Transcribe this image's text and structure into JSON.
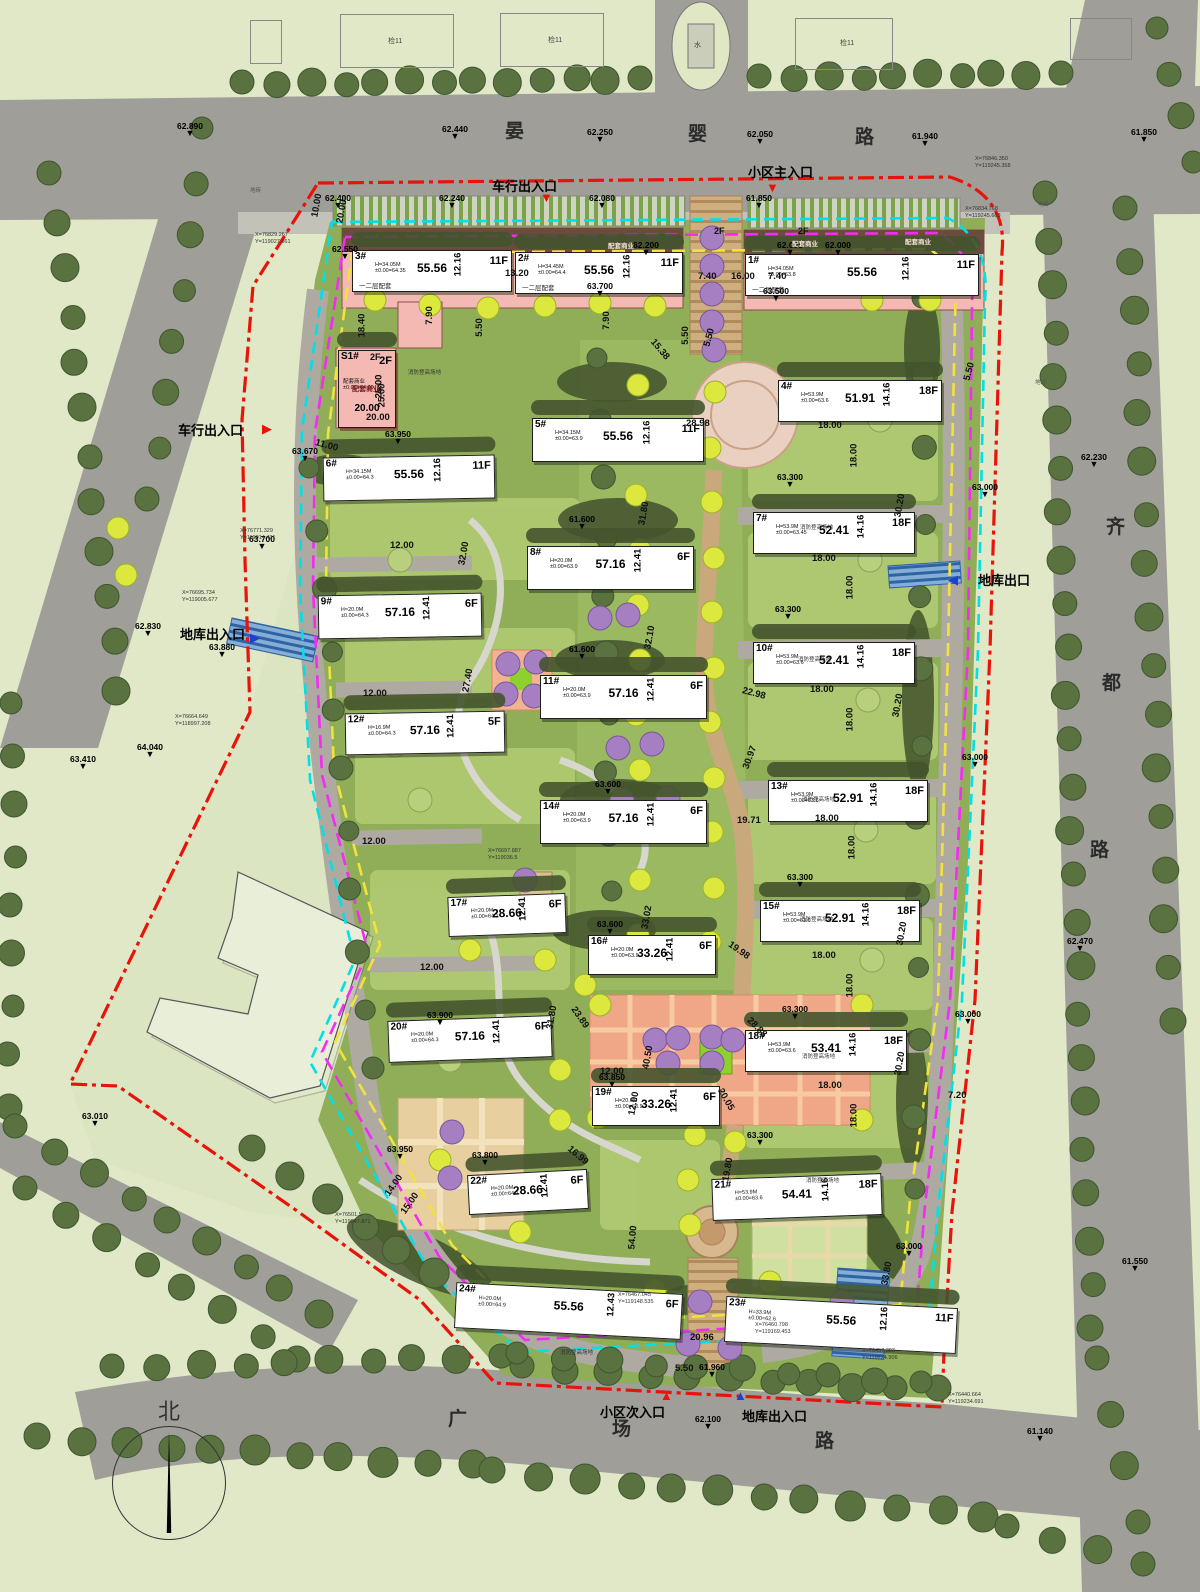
{
  "title": "住宅小区总平面图",
  "colors": {
    "boundary_red": "#e81309",
    "boundary_cyan": "#00e0e6",
    "boundary_magenta": "#f32bf3",
    "setback_yellow": "#f2e23c",
    "road_gray": "#9f9e99",
    "site_green": "#8fae57",
    "podium_pink": "#f3b9b2",
    "axis_tan": "#c9a87c",
    "plaza_orange": "#efa788",
    "tree_olive": "#5a7140",
    "tree_yellow": "#dce83e",
    "tree_purple": "#a57fc2",
    "ramp_blue": "#2f63a4",
    "entry_red": "#e81309",
    "entry_blue": "#1d3fd4"
  },
  "compass": {
    "label": "北"
  },
  "roads": {
    "north": {
      "name": "晏婴路",
      "chars": [
        {
          "ch": "晏",
          "x": 505,
          "y": 116
        },
        {
          "ch": "婴",
          "x": 688,
          "y": 119
        },
        {
          "ch": "路",
          "x": 855,
          "y": 122
        }
      ]
    },
    "east": {
      "name": "齐都路",
      "chars": [
        {
          "ch": "齐",
          "x": 1106,
          "y": 512
        },
        {
          "ch": "都",
          "x": 1102,
          "y": 668
        },
        {
          "ch": "路",
          "x": 1090,
          "y": 835
        }
      ]
    },
    "south": {
      "name": "广场路",
      "chars": [
        {
          "ch": "广",
          "x": 448,
          "y": 1404
        },
        {
          "ch": "场",
          "x": 612,
          "y": 1414
        },
        {
          "ch": "路",
          "x": 815,
          "y": 1426
        }
      ]
    }
  },
  "entrances": [
    {
      "label": "车行出入口",
      "x": 492,
      "y": 176,
      "ax": 540,
      "ay": 190,
      "glyph": "▼",
      "color": "#e81309"
    },
    {
      "label": "小区主入口",
      "x": 748,
      "y": 162,
      "ax": 766,
      "ay": 180,
      "glyph": "▼",
      "color": "#e81309"
    },
    {
      "label": "车行出入口",
      "x": 178,
      "y": 420,
      "ax": 262,
      "ay": 421,
      "glyph": "▶",
      "color": "#e81309"
    },
    {
      "label": "地库出入口",
      "x": 180,
      "y": 624,
      "ax": 250,
      "ay": 630,
      "glyph": "▶",
      "color": "#1d3fd4"
    },
    {
      "label": "地库出口",
      "x": 978,
      "y": 570,
      "ax": 948,
      "ay": 572,
      "glyph": "◀",
      "color": "#1d3fd4"
    },
    {
      "label": "小区次入口",
      "x": 600,
      "y": 1402,
      "ax": 660,
      "ay": 1388,
      "glyph": "▲",
      "color": "#e81309"
    },
    {
      "label": "地库出入口",
      "x": 742,
      "y": 1406,
      "ax": 734,
      "ay": 1388,
      "glyph": "▲",
      "color": "#1d3fd4"
    }
  ],
  "buildings": [
    {
      "id": "3#",
      "x": 352,
      "y": 250,
      "w": 158,
      "h": 40,
      "r": 0,
      "len": "55.56",
      "dep": "12.16",
      "fl": "11F",
      "info": "H=34.05M\n±0.00=64.35",
      "note": "一二层配套"
    },
    {
      "id": "2#",
      "x": 515,
      "y": 252,
      "w": 166,
      "h": 40,
      "r": 0,
      "len": "55.56",
      "dep": "12.16",
      "fl": "11F",
      "info": "H=34.45M\n±0.00=64.4",
      "note": "一二层配套"
    },
    {
      "id": "1#",
      "x": 745,
      "y": 254,
      "w": 232,
      "h": 40,
      "r": 0,
      "len": "55.56",
      "dep": "12.16",
      "fl": "11F",
      "info": "H=34.05M\n±0.00=63.8",
      "note": "一二层配套"
    },
    {
      "id": "S1#",
      "x": 338,
      "y": 350,
      "w": 56,
      "h": 76,
      "r": 0,
      "len": "20.00",
      "dep": "25.00",
      "fl": "2F",
      "info": "配套商业\n±0.00=64.00",
      "pink": true
    },
    {
      "id": "6#",
      "x": 323,
      "y": 456,
      "w": 170,
      "h": 42,
      "r": -1,
      "len": "55.56",
      "dep": "12.16",
      "fl": "11F",
      "info": "H=34.15M\n±0.00=64.3"
    },
    {
      "id": "5#",
      "x": 532,
      "y": 418,
      "w": 170,
      "h": 42,
      "r": 0,
      "len": "55.56",
      "dep": "12.16",
      "fl": "11F",
      "info": "H=34.15M\n±0.00=63.9"
    },
    {
      "id": "4#",
      "x": 778,
      "y": 380,
      "w": 162,
      "h": 40,
      "r": 0,
      "len": "51.91",
      "dep": "14.16",
      "fl": "18F",
      "info": "H=53.9M\n±0.00=63.6"
    },
    {
      "id": "9#",
      "x": 318,
      "y": 594,
      "w": 162,
      "h": 42,
      "r": -1,
      "len": "57.16",
      "dep": "12.41",
      "fl": "6F",
      "info": "H=20.0M\n±0.00=64.3"
    },
    {
      "id": "8#",
      "x": 527,
      "y": 546,
      "w": 165,
      "h": 42,
      "r": 0,
      "len": "57.16",
      "dep": "12.41",
      "fl": "6F",
      "info": "H=20.0M\n±0.00=63.9"
    },
    {
      "id": "7#",
      "x": 753,
      "y": 512,
      "w": 160,
      "h": 40,
      "r": 0,
      "len": "52.41",
      "dep": "14.16",
      "fl": "18F",
      "info": "H=53.9M\n±0.00=63.45"
    },
    {
      "id": "12#",
      "x": 345,
      "y": 712,
      "w": 158,
      "h": 40,
      "r": -1,
      "len": "57.16",
      "dep": "12.41",
      "fl": "5F",
      "info": "H=16.9M\n±0.00=64.3"
    },
    {
      "id": "11#",
      "x": 540,
      "y": 675,
      "w": 165,
      "h": 42,
      "r": 0,
      "len": "57.16",
      "dep": "12.41",
      "fl": "6F",
      "info": "H=20.0M\n±0.00=63.9"
    },
    {
      "id": "10#",
      "x": 753,
      "y": 642,
      "w": 160,
      "h": 40,
      "r": 0,
      "len": "52.41",
      "dep": "14.16",
      "fl": "18F",
      "info": "H=53.9M\n±0.00=63.6"
    },
    {
      "id": "14#",
      "x": 540,
      "y": 800,
      "w": 165,
      "h": 42,
      "r": 0,
      "len": "57.16",
      "dep": "12.41",
      "fl": "6F",
      "info": "H=20.0M\n±0.00=63.9"
    },
    {
      "id": "13#",
      "x": 768,
      "y": 780,
      "w": 158,
      "h": 40,
      "r": 0,
      "len": "52.91",
      "dep": "14.16",
      "fl": "18F",
      "info": "H=53.9M\n±0.00=63.6"
    },
    {
      "id": "17#",
      "x": 448,
      "y": 895,
      "w": 116,
      "h": 38,
      "r": -2,
      "len": "28.66",
      "dep": "12.41",
      "fl": "6F",
      "info": "H=20.0M\n±0.00=64.1"
    },
    {
      "id": "16#",
      "x": 588,
      "y": 935,
      "w": 126,
      "h": 38,
      "r": 0,
      "len": "33.26",
      "dep": "12.41",
      "fl": "6F",
      "info": "H=20.0M\n±0.00=63.9"
    },
    {
      "id": "15#",
      "x": 760,
      "y": 900,
      "w": 158,
      "h": 40,
      "r": 0,
      "len": "52.91",
      "dep": "14.16",
      "fl": "18F",
      "info": "H=53.9M\n±0.00=63.6"
    },
    {
      "id": "20#",
      "x": 388,
      "y": 1018,
      "w": 162,
      "h": 40,
      "r": -2,
      "len": "57.16",
      "dep": "12.41",
      "fl": "6F",
      "info": "H=20.0M\n±0.00=64.3"
    },
    {
      "id": "19#",
      "x": 592,
      "y": 1086,
      "w": 126,
      "h": 38,
      "r": 0,
      "len": "33.26",
      "dep": "12.41",
      "fl": "6F",
      "info": "H=20.0M\n±0.00=63.9"
    },
    {
      "id": "18#",
      "x": 745,
      "y": 1030,
      "w": 160,
      "h": 40,
      "r": 0,
      "len": "53.41",
      "dep": "14.16",
      "fl": "18F",
      "info": "H=53.9M\n±0.00=63.6"
    },
    {
      "id": "22#",
      "x": 468,
      "y": 1172,
      "w": 118,
      "h": 38,
      "r": -3,
      "len": "28.66",
      "dep": "12.41",
      "fl": "6F",
      "info": "H=20.0M\n±0.00=64.1"
    },
    {
      "id": "21#",
      "x": 712,
      "y": 1176,
      "w": 168,
      "h": 40,
      "r": -2,
      "len": "54.41",
      "dep": "14.16",
      "fl": "18F",
      "info": "H=53.9M\n±0.00=63.6"
    },
    {
      "id": "24#",
      "x": 455,
      "y": 1288,
      "w": 225,
      "h": 44,
      "r": 3,
      "len": "55.56",
      "dep": "12.43",
      "fl": "6F",
      "info": "H=20.0M\n±0.00=64.9"
    },
    {
      "id": "23#",
      "x": 725,
      "y": 1302,
      "w": 230,
      "h": 44,
      "r": 3,
      "len": "55.56",
      "dep": "12.16",
      "fl": "11F",
      "info": "H=33.9M\n±0.00=62.6"
    }
  ],
  "elevations": [
    [
      190,
      127,
      "62.890"
    ],
    [
      455,
      130,
      "62.440"
    ],
    [
      600,
      133,
      "62.250"
    ],
    [
      760,
      135,
      "62.050"
    ],
    [
      925,
      137,
      "61.940"
    ],
    [
      1144,
      133,
      "61.850"
    ],
    [
      338,
      199,
      "62.400"
    ],
    [
      452,
      199,
      "62.240"
    ],
    [
      602,
      199,
      "62.080"
    ],
    [
      759,
      199,
      "61.850"
    ],
    [
      646,
      246,
      "62.200"
    ],
    [
      790,
      246,
      "62.000"
    ],
    [
      838,
      246,
      "62.000"
    ],
    [
      345,
      250,
      "62.550"
    ],
    [
      148,
      627,
      "62.830"
    ],
    [
      95,
      1117,
      "63.010"
    ],
    [
      83,
      760,
      "63.410"
    ],
    [
      150,
      748,
      "64.040"
    ],
    [
      262,
      540,
      "63.700"
    ],
    [
      222,
      648,
      "63.880"
    ],
    [
      305,
      452,
      "63.670"
    ],
    [
      398,
      435,
      "63.950"
    ],
    [
      600,
      287,
      "63.700"
    ],
    [
      776,
      292,
      "63.500"
    ],
    [
      582,
      520,
      "61.600"
    ],
    [
      582,
      650,
      "61.600"
    ],
    [
      790,
      478,
      "63.300"
    ],
    [
      788,
      610,
      "63.300"
    ],
    [
      800,
      878,
      "63.300"
    ],
    [
      795,
      1010,
      "63.300"
    ],
    [
      760,
      1136,
      "63.300"
    ],
    [
      985,
      488,
      "63.000"
    ],
    [
      975,
      758,
      "63.000"
    ],
    [
      968,
      1015,
      "63.000"
    ],
    [
      909,
      1247,
      "63.000"
    ],
    [
      608,
      785,
      "63.600"
    ],
    [
      610,
      925,
      "63.600"
    ],
    [
      440,
      1016,
      "63.900"
    ],
    [
      400,
      1150,
      "63.950"
    ],
    [
      485,
      1156,
      "63.800"
    ],
    [
      612,
      1078,
      "63.850"
    ],
    [
      712,
      1368,
      "61.960"
    ],
    [
      708,
      1420,
      "62.100"
    ],
    [
      1094,
      458,
      "62.230"
    ],
    [
      1080,
      942,
      "62.470"
    ],
    [
      1135,
      1262,
      "61.550"
    ],
    [
      1040,
      1432,
      "61.140"
    ]
  ],
  "dimensions": [
    [
      505,
      268,
      "13.20",
      0
    ],
    [
      698,
      271,
      "7.40",
      0
    ],
    [
      731,
      271,
      "16.00",
      0
    ],
    [
      768,
      271,
      "7.40",
      0
    ],
    [
      350,
      320,
      "18.40",
      90
    ],
    [
      420,
      310,
      "7.90",
      90
    ],
    [
      470,
      322,
      "5.50",
      90
    ],
    [
      597,
      315,
      "7.90",
      90
    ],
    [
      676,
      330,
      "5.50",
      90
    ],
    [
      370,
      390,
      "25.00",
      90
    ],
    [
      366,
      412,
      "20.00",
      0
    ],
    [
      305,
      200,
      "10.00",
      80
    ],
    [
      330,
      206,
      "20.00",
      80
    ],
    [
      648,
      344,
      "15.38",
      -50
    ],
    [
      686,
      418,
      "28.98",
      0
    ],
    [
      700,
      332,
      "5.50",
      75
    ],
    [
      818,
      420,
      "18.00",
      0
    ],
    [
      842,
      450,
      "18.00",
      90
    ],
    [
      812,
      553,
      "18.00",
      0
    ],
    [
      838,
      582,
      "18.00",
      90
    ],
    [
      810,
      684,
      "18.00",
      0
    ],
    [
      838,
      714,
      "18.00",
      90
    ],
    [
      815,
      813,
      "18.00",
      0
    ],
    [
      840,
      842,
      "18.00",
      90
    ],
    [
      812,
      950,
      "18.00",
      0
    ],
    [
      838,
      980,
      "18.00",
      90
    ],
    [
      818,
      1080,
      "18.00",
      0
    ],
    [
      842,
      1110,
      "18.00",
      90
    ],
    [
      888,
      500,
      "30.20",
      80
    ],
    [
      886,
      700,
      "30.20",
      80
    ],
    [
      890,
      928,
      "30.20",
      80
    ],
    [
      888,
      1058,
      "30.20",
      80
    ],
    [
      390,
      540,
      "12.00",
      0
    ],
    [
      363,
      688,
      "12.00",
      0
    ],
    [
      362,
      836,
      "12.00",
      0
    ],
    [
      420,
      962,
      "12.00",
      0
    ],
    [
      452,
      548,
      "32.00",
      80
    ],
    [
      456,
      675,
      "27.40",
      80
    ],
    [
      632,
      508,
      "31.80",
      80
    ],
    [
      638,
      632,
      "32.10",
      80
    ],
    [
      540,
      1012,
      "31.80",
      80
    ],
    [
      635,
      912,
      "33.02",
      80
    ],
    [
      742,
      688,
      "22.98",
      -15
    ],
    [
      738,
      752,
      "30.97",
      70
    ],
    [
      737,
      815,
      "19.71",
      0
    ],
    [
      727,
      945,
      "19.98",
      -35
    ],
    [
      568,
      1012,
      "23.89",
      -55
    ],
    [
      636,
      1052,
      "40.50",
      80
    ],
    [
      600,
      1066,
      "12.00",
      0
    ],
    [
      622,
      1098,
      "12.00",
      80
    ],
    [
      745,
      1022,
      "28.88",
      -45
    ],
    [
      714,
      1094,
      "20.05",
      -60
    ],
    [
      716,
      1164,
      "19.80",
      80
    ],
    [
      566,
      1150,
      "16.99",
      -40
    ],
    [
      621,
      1232,
      "54.00",
      85
    ],
    [
      875,
      1268,
      "33.80",
      80
    ],
    [
      690,
      1332,
      "20.96",
      0
    ],
    [
      675,
      1363,
      "5.50",
      0
    ],
    [
      382,
      1180,
      "14.00",
      55
    ],
    [
      398,
      1198,
      "15.00",
      55
    ],
    [
      315,
      440,
      "11.00",
      -15
    ],
    [
      948,
      1090,
      "7.20",
      0
    ],
    [
      960,
      366,
      "5.50",
      75
    ]
  ],
  "coords": [
    [
      975,
      156,
      "X=76846.350\nY=119245.358"
    ],
    [
      965,
      206,
      "X=76834.768\nY=119245.663"
    ],
    [
      255,
      232,
      "X=76829.267\nY=119027.861"
    ],
    [
      240,
      528,
      "X=76771.329\nY=119014.431"
    ],
    [
      182,
      590,
      "X=76695.734\nY=119005.677"
    ],
    [
      175,
      714,
      "X=76664.649\nY=118997.208"
    ],
    [
      488,
      848,
      "X=76697.887\nY=119036.5"
    ],
    [
      618,
      1292,
      "X=76467.045\nY=119148.535"
    ],
    [
      755,
      1322,
      "X=76460.798\nY=119169.453"
    ],
    [
      862,
      1348,
      "X=76457.303\nY=119224.906"
    ],
    [
      948,
      1392,
      "X=76440.664\nY=119234.691"
    ],
    [
      335,
      1212,
      "X=76501.5\nY=119047.871"
    ]
  ],
  "area_labels": [
    [
      800,
      523,
      "消防登高场地",
      "fire"
    ],
    [
      798,
      655,
      "消防登高场地",
      "fire"
    ],
    [
      802,
      795,
      "消防登高场地",
      "fire"
    ],
    [
      800,
      915,
      "消防登高场地",
      "fire"
    ],
    [
      802,
      1052,
      "消防登高场地",
      "fire"
    ],
    [
      806,
      1176,
      "消防登高场地",
      "fire"
    ],
    [
      560,
      1348,
      "消防登高场地",
      "fire"
    ],
    [
      408,
      368,
      "消防登高场地",
      "fire"
    ],
    [
      608,
      240,
      "配套商业",
      "biz"
    ],
    [
      792,
      238,
      "配套商业",
      "biz"
    ],
    [
      905,
      236,
      "配套商业",
      "biz"
    ],
    [
      352,
      384,
      "配套商业",
      "biz2"
    ],
    [
      714,
      226,
      "2F",
      "f2"
    ],
    [
      798,
      226,
      "2F",
      "f2"
    ],
    [
      370,
      352,
      "2F",
      "f2"
    ],
    [
      388,
      36,
      "检11",
      "ctx"
    ],
    [
      548,
      35,
      "检11",
      "ctx"
    ],
    [
      840,
      38,
      "检11",
      "ctx"
    ],
    [
      694,
      40,
      "水",
      "ctx"
    ],
    [
      250,
      186,
      "地砖",
      "tile"
    ],
    [
      1038,
      200,
      "地砖",
      "tile"
    ],
    [
      1035,
      378,
      "地砖",
      "tile"
    ]
  ],
  "context_outlines": [
    [
      340,
      14,
      112,
      52
    ],
    [
      500,
      13,
      102,
      52
    ],
    [
      795,
      18,
      96,
      50
    ],
    [
      1070,
      18,
      60,
      40
    ],
    [
      250,
      20,
      30,
      42
    ]
  ]
}
